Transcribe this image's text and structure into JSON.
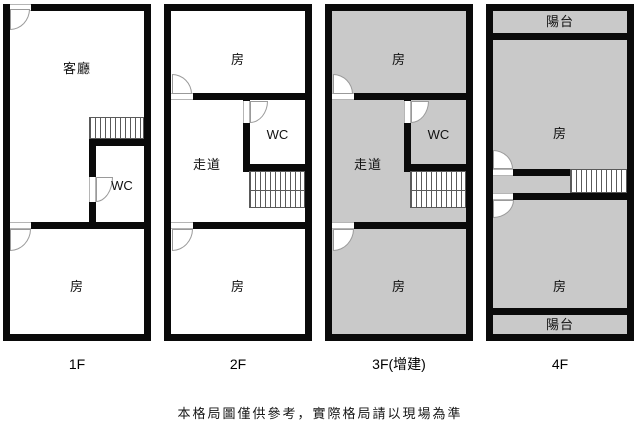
{
  "disclaimer": "本格局圖僅供參考，實際格局請以現場為準",
  "colors": {
    "wall": "#0a0a0a",
    "addition_fill": "#c9c9c9",
    "base_fill": "#ffffff",
    "door_stroke": "#9a9a9a",
    "stair_stroke": "#5a5a5a"
  },
  "floors": [
    {
      "label": "1F",
      "rooms": {
        "living": "客廳",
        "wc": "WC",
        "room_bottom": "房"
      }
    },
    {
      "label": "2F",
      "rooms": {
        "room_top": "房",
        "wc": "WC",
        "corridor": "走道",
        "room_bottom": "房"
      }
    },
    {
      "label": "3F(增建)",
      "rooms": {
        "room_top": "房",
        "wc": "WC",
        "corridor": "走道",
        "room_bottom": "房"
      }
    },
    {
      "label": "4F",
      "rooms": {
        "balcony_top": "陽台",
        "room_top": "房",
        "room_bottom": "房",
        "balcony_bottom": "陽台"
      }
    }
  ]
}
